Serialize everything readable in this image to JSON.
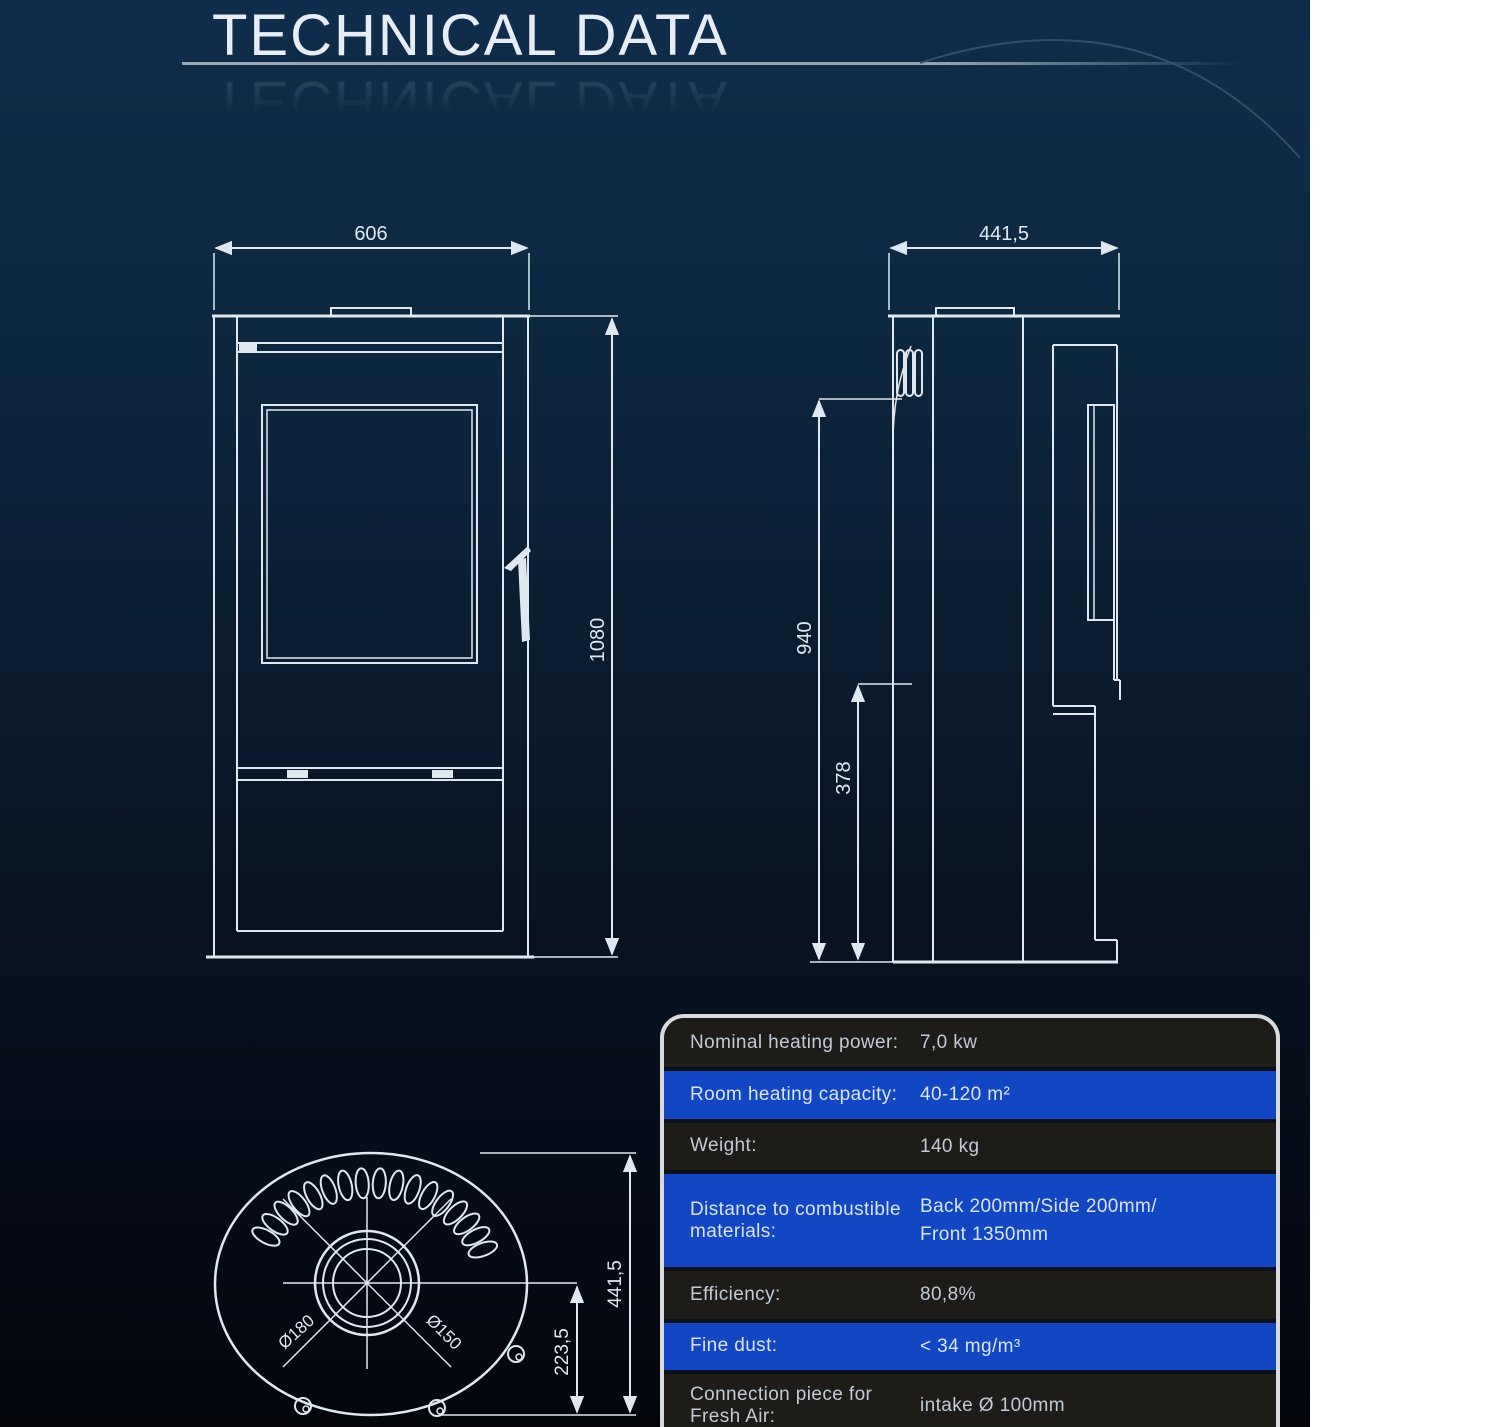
{
  "page": {
    "title": "TECHNICAL DATA"
  },
  "front_view": {
    "width_label": "606",
    "height_label": "1080"
  },
  "side_view": {
    "depth_label": "441,5",
    "height_label": "940",
    "lower_height_label": "378"
  },
  "top_view": {
    "depth_label": "441,5",
    "center_offset_label": "223,5",
    "collar_outer_label": "Ø180",
    "collar_inner_label": "Ø150"
  },
  "spec_table": {
    "rows": [
      {
        "label": "Nominal heating power:",
        "value": "7,0 kw"
      },
      {
        "label": "Room heating capacity:",
        "value": "40-120 m²"
      },
      {
        "label": "Weight:",
        "value": "140 kg"
      },
      {
        "label": "Distance to combustible materials:",
        "value": "Back 200mm/Side 200mm/\nFront 1350mm"
      },
      {
        "label": "Efficiency:",
        "value": "80,8%"
      },
      {
        "label": "Fine dust:",
        "value": "< 34 mg/m³"
      },
      {
        "label": "Connection piece for Fresh Air:",
        "value": "intake Ø 100mm"
      },
      {
        "label": "",
        "value": ""
      }
    ]
  },
  "colors": {
    "accent_blue": "#1246c2",
    "row_dark": "#1d1c19",
    "drawing_line": "#dfe8f0",
    "background_top": "#0e2c4c",
    "background_bottom": "#04060c",
    "table_border": "#d9dadc"
  }
}
